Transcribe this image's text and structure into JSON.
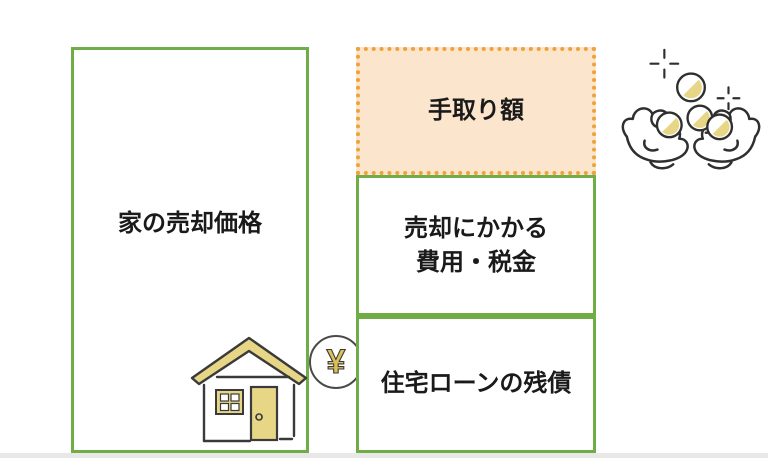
{
  "boxes": {
    "sale_price": {
      "label": "家の売却価格"
    },
    "take_home": {
      "label": "手取り額"
    },
    "selling_costs": {
      "line1": "売却にかかる",
      "line2": "費用・税金"
    },
    "loan_balance": {
      "label": "住宅ローンの残債"
    }
  },
  "icons": {
    "yen_symbol": "¥",
    "house": "house-with-yen-coin",
    "hands": "hands-receiving-coins",
    "sparkles": "sparkle-plus-marks"
  },
  "colors": {
    "box_border_green": "#70AD47",
    "takehome_fill": "#FBE5CC",
    "takehome_dot_border": "#EDA33C",
    "illustration_yellow": "#E8D687",
    "outline_dark": "#3A3A3A",
    "text": "#1A1A1A",
    "bottom_strip": "#E8E8E8"
  }
}
